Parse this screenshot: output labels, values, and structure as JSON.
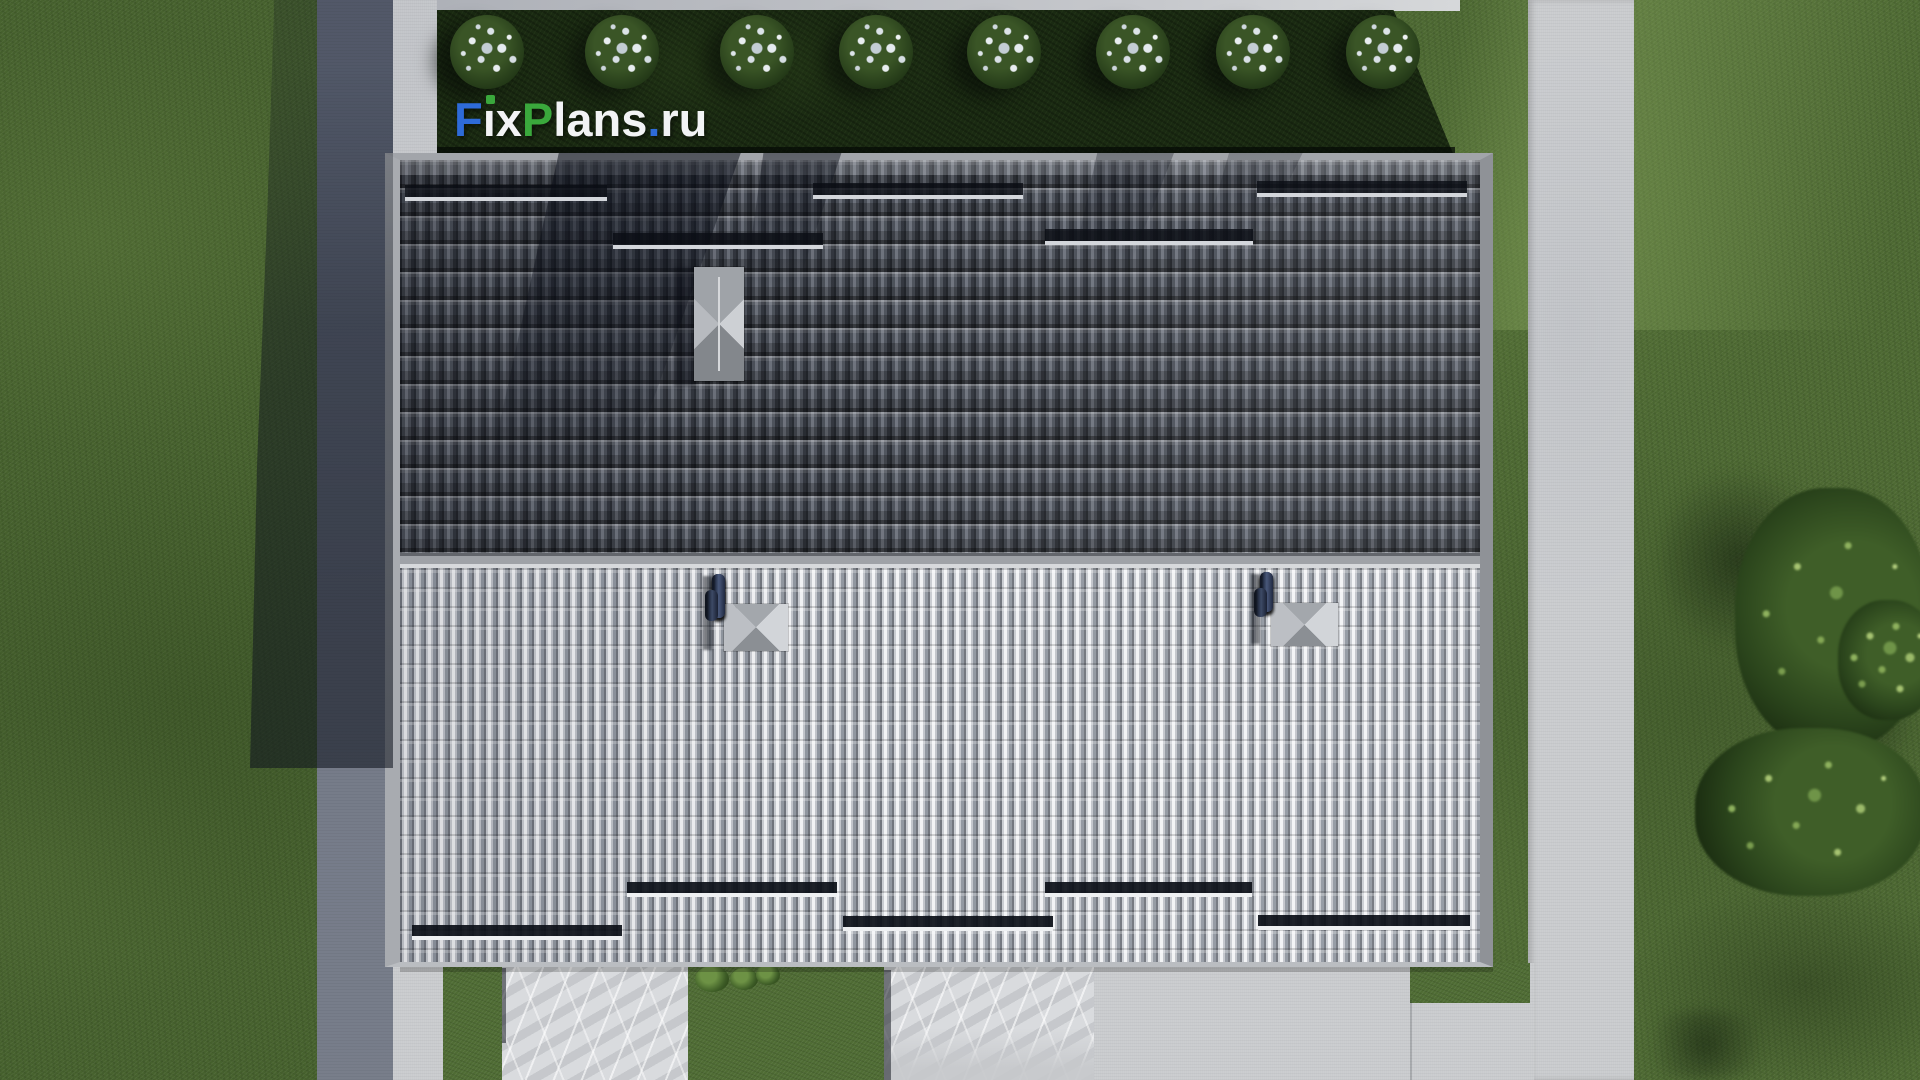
{
  "watermark": {
    "f": "F",
    "i_body": "ı",
    "x": "x",
    "p": "P",
    "lans": "lans",
    "tld_dot": ".",
    "tld": "ru"
  },
  "palette": {
    "grass_left": "#47622e",
    "grass_right": "#4e6a33",
    "hedge": "#1a2a12",
    "concrete_path": "#9aa0ae",
    "concrete_bright": "#c9cbce",
    "roof_dark": "#4a4f58",
    "roof_light": "#b7bac0",
    "divider": "#9fa2a7",
    "fascia": "#9b9ea3",
    "chimney": "#a8acb1",
    "marble": "#d9dbde",
    "pipes_navy": "#27304a",
    "logo_blue": "#2e6bd8",
    "logo_green": "#3aa83c",
    "logo_white": "#f2f3f5",
    "bush_speckle": "#dde4e8",
    "tree_dark": "#203617",
    "tree_light": "#6f9448"
  }
}
